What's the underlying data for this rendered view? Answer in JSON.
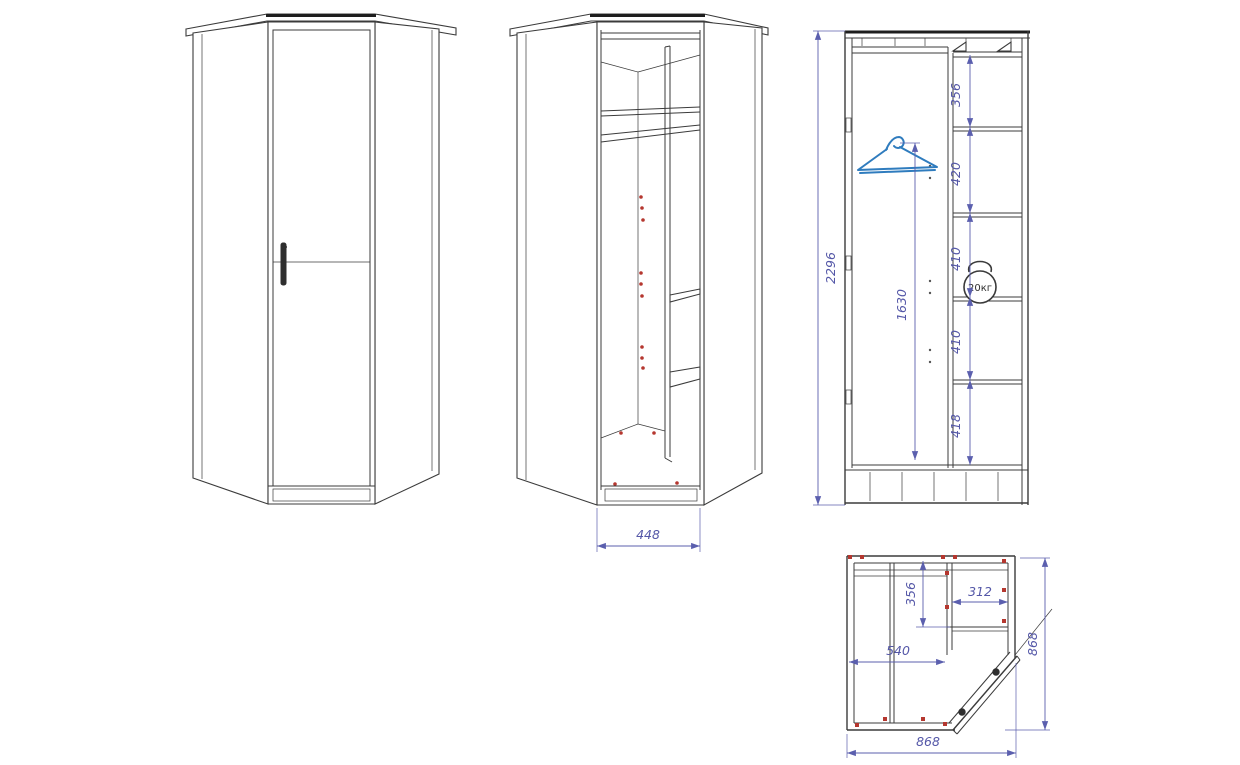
{
  "colors": {
    "background": "#ffffff",
    "line": "#3b3b3b",
    "dimension": "#5b5fae",
    "dimension_text": "#5558a8",
    "hanger_blue": "#2f7cbe",
    "fastener_red": "#b5372f"
  },
  "views": {
    "front_open": {
      "opening_width": "448"
    },
    "section": {
      "overall_height": "2296",
      "hanger_drop": "1630",
      "shelf_spacings": [
        "356",
        "420",
        "410",
        "410",
        "418"
      ],
      "shelf_load": "20кг"
    },
    "plan": {
      "side_depth": "356",
      "side_width": "312",
      "front_width": "540",
      "overall_width": "868",
      "overall_depth": "868"
    }
  },
  "icons": {
    "hanger": "hanger-icon",
    "kettlebell": "kettlebell-weight-icon"
  }
}
